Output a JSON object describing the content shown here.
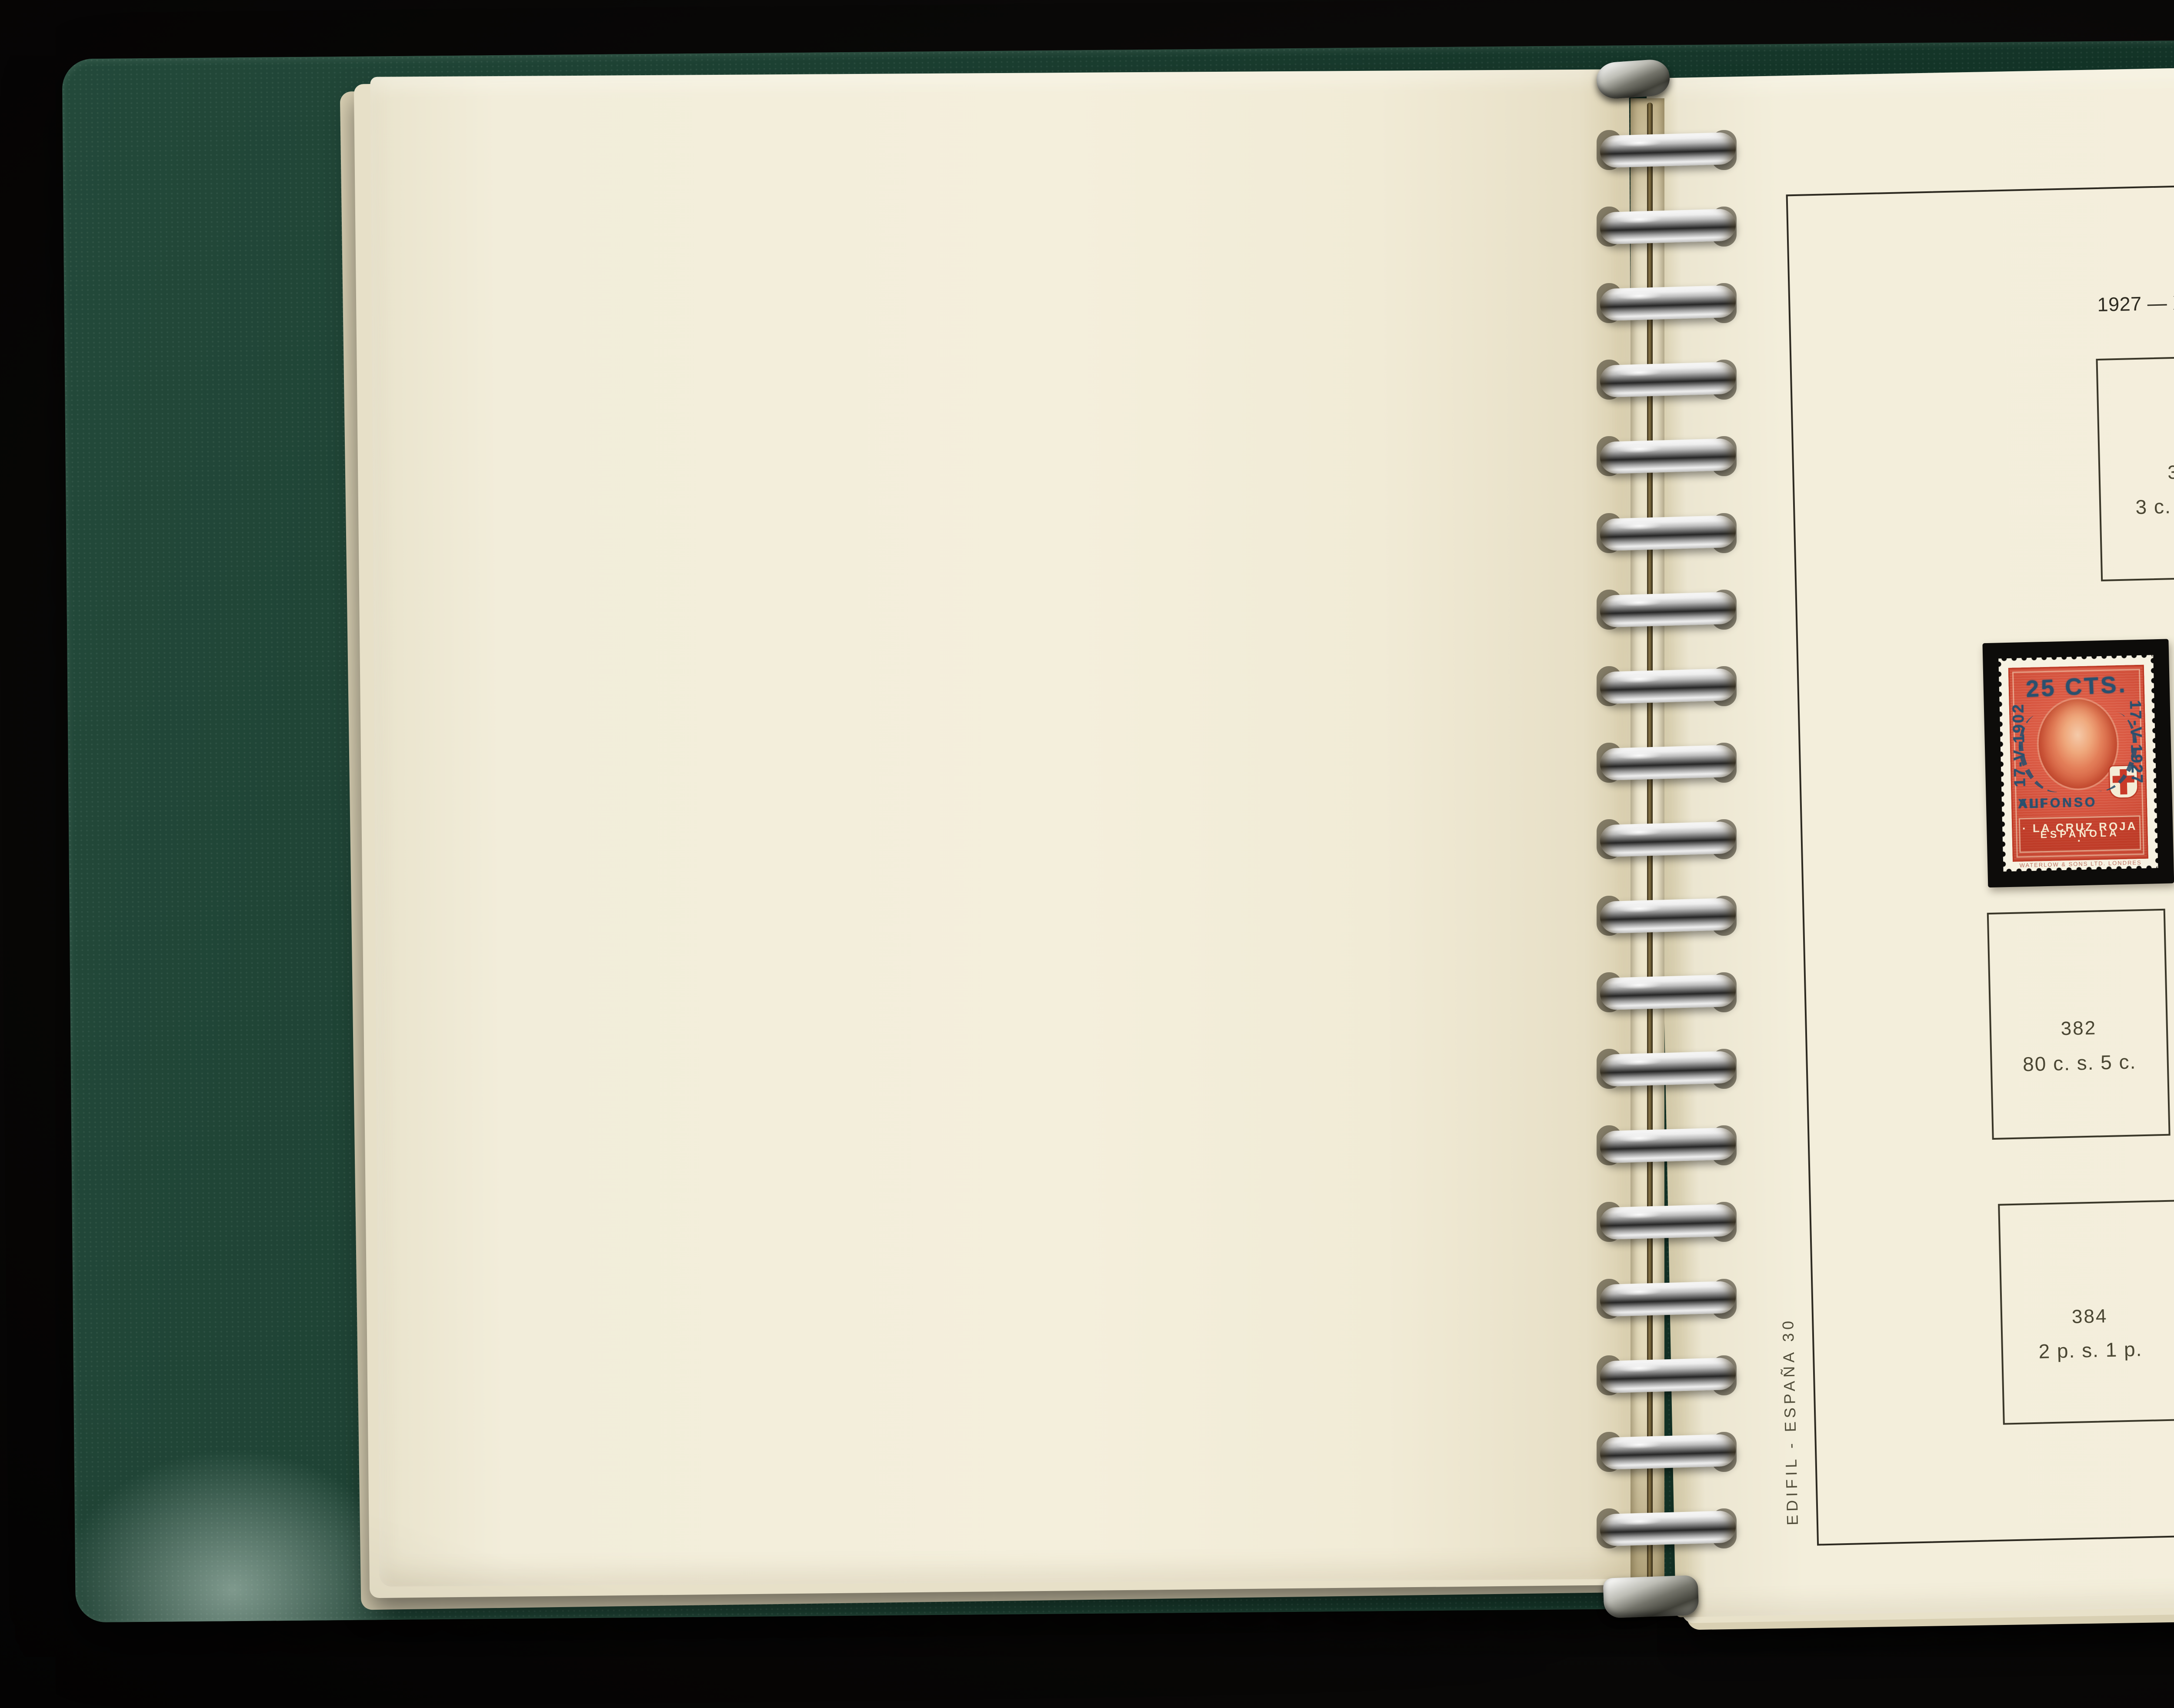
{
  "photo": {
    "background_color": "#0a0908",
    "album": {
      "cover_color": "#1c4634",
      "page_color": "#f2edda",
      "binder": {
        "ring_count": 19,
        "ring_metal_color": "#d9d9d9",
        "spine_strip_color": "#e7dfc4"
      }
    }
  },
  "page": {
    "header": "ESPAÑA",
    "title": "1927 — XXV Aniversario Coronación Alfonso XIII — Nuevos valores",
    "side_caption": "EDIFIL - ESPAÑA 30",
    "pencil_note": "12",
    "boxes": [
      {
        "number": "373",
        "value": "3 c. s. 2 c."
      },
      {
        "number": "374",
        "value": "4 c. s. 2 c."
      },
      {
        "number": "377",
        "value": "55 c. s. 2 c."
      },
      {
        "number": "378",
        "value": "55 c. s. 10 c."
      },
      {
        "number": "379",
        "value": "55 c. s. 20 c."
      },
      {
        "number": "382",
        "value": "80 c. s. 5 c."
      },
      {
        "number": "380",
        "value": "75 c. s. 15 c."
      },
      {
        "number": "381",
        "value": "75 c. s. 30 c."
      },
      {
        "number": "383",
        "value": "2 p. s. 40 c."
      },
      {
        "number": "384",
        "value": "2 p. s. 1 p."
      },
      {
        "number": "385",
        "value": "5 p. s. 50 c."
      },
      {
        "number": "386",
        "value": "5 p. s. 4 p."
      },
      {
        "number": "387",
        "value": "10 p. s. 10 p."
      }
    ]
  },
  "stamps": [
    {
      "mount_color": "#0d0c0a",
      "base_color": "#d5503a",
      "overprint_color": "#1f1b14",
      "overprint_value": "10 CTS.",
      "date_left": "17-V-1902",
      "date_right": "17-V-1927",
      "name_left": "ALFONSO",
      "name_right": "XIII",
      "banner_line1": "· LA CRUZ ROJA ·",
      "banner_line2": "ESPAÑOLA",
      "printer_line": "WATERLOW & SONS LTD. LONDRES"
    },
    {
      "mount_color": "#0d0c0a",
      "base_color": "#d5503a",
      "overprint_color": "#2a506e",
      "overprint_value": "25 CTS.",
      "date_left": "17-V-1902",
      "date_right": "17-V-1927",
      "name_left": "ALFONSO",
      "name_right": "XIII",
      "banner_line1": "· LA CRUZ ROJA ·",
      "banner_line2": "ESPAÑOLA",
      "printer_line": "WATERLOW & SONS LTD. LONDRES"
    }
  ]
}
